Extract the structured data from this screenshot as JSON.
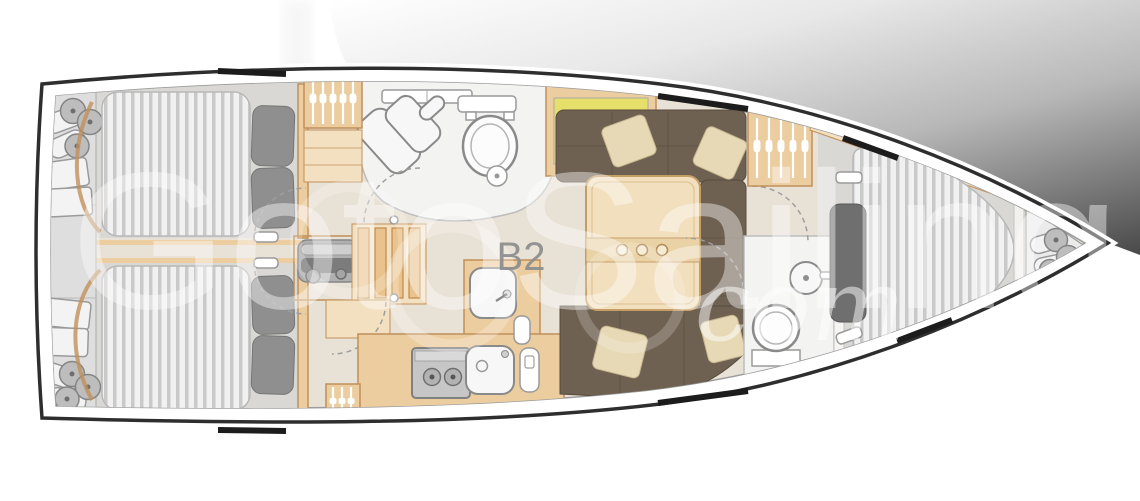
{
  "window": {
    "width": 1140,
    "height": 501
  },
  "diagram": {
    "type": "yacht-interior-floor-plan",
    "unit_label": "B2",
    "watermark": {
      "main": "GotoSailing",
      "suffix": "com"
    },
    "colors": {
      "hull_outline": "#2e2e2e",
      "interior_floor": "#e8e1d5",
      "cabin_floor": "#d9d8d5",
      "wood": "#eccda0",
      "wood_light": "#f2e0c0",
      "wood_dark": "#c0905a",
      "mattress": "#f1f1f1",
      "mattress_stripe": "#c9c9c9",
      "pillow_gray": "#8f8f8f",
      "settee": "#6e6151",
      "settee_pillow": "#e7d9b6",
      "fixture_white": "#f7f7f7",
      "engine_gray": "#b0b0b0",
      "chart_yellow": "#e6e06a",
      "chart_green": "#93bf63",
      "watermark_white": "#ffffff",
      "label_gray": "#8f8f8f",
      "shading_dark": "#464646"
    }
  }
}
